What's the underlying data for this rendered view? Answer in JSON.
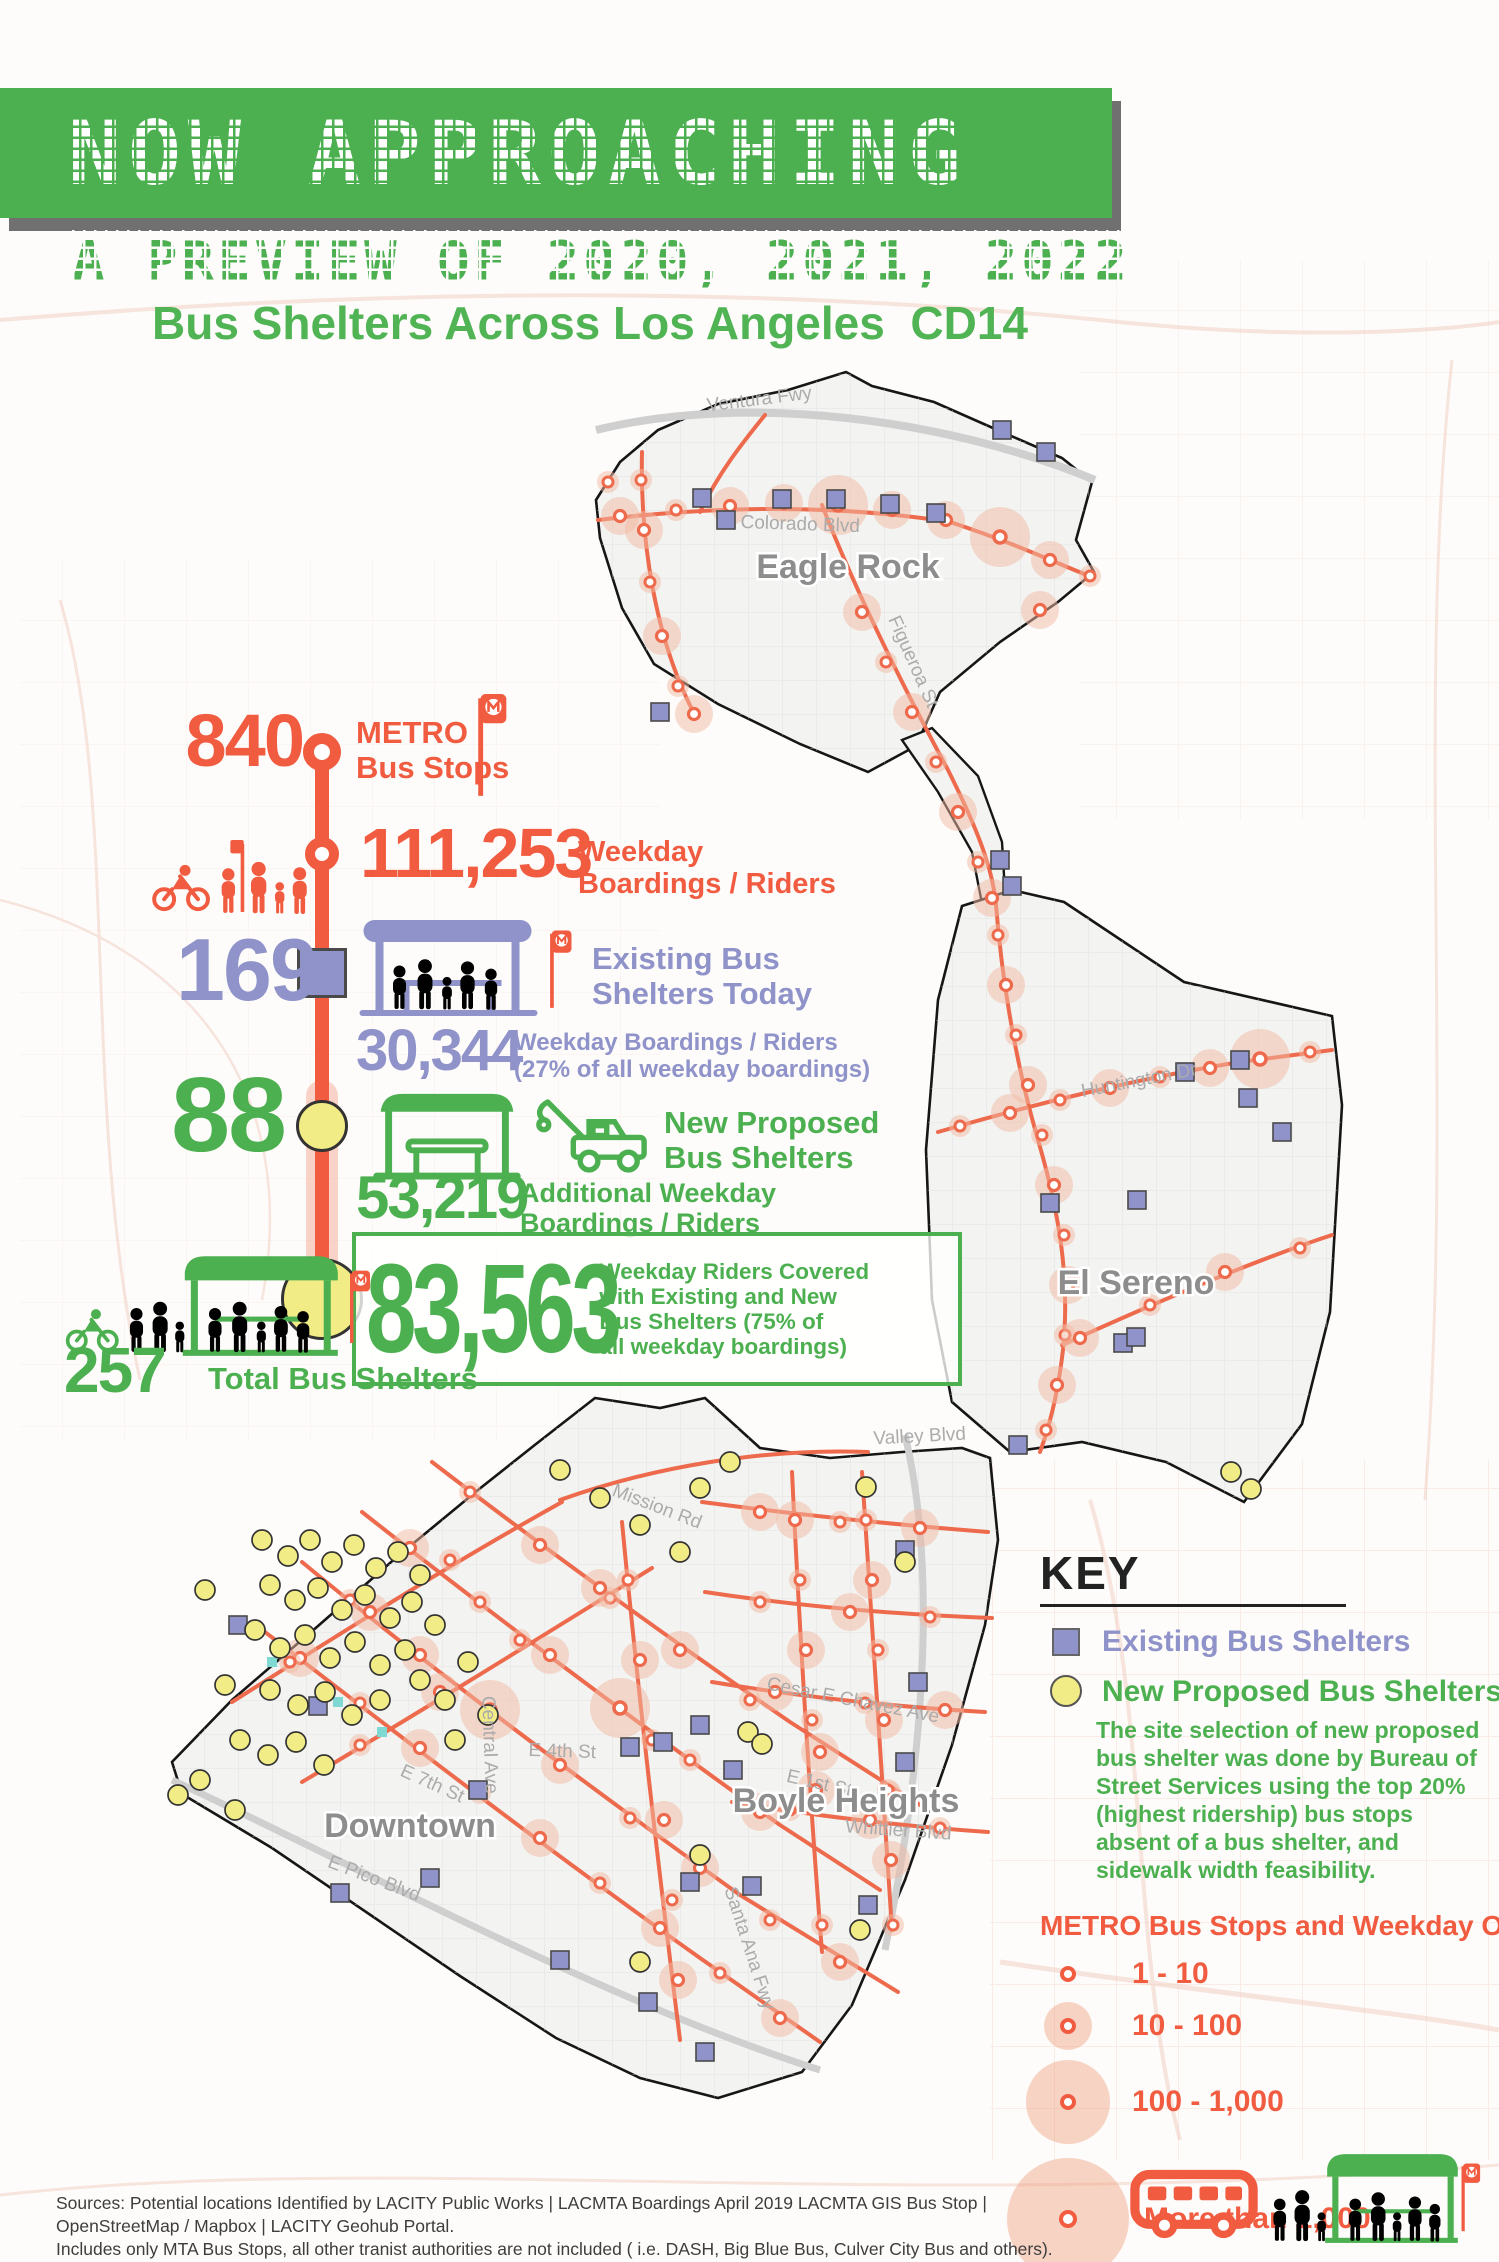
{
  "poster": {
    "banner_title": "NOW APPROACHING",
    "subtitle": "A PREVIEW OF 2020, 2021, 2022",
    "title": "Bus Shelters Across Los Angeles  CD14"
  },
  "stats": {
    "metro_stops": {
      "value": "840",
      "label": "METRO\nBus Stops"
    },
    "boardings": {
      "value": "111,253",
      "label": "Weekday\nBoardings / Riders"
    },
    "existing": {
      "value": "169",
      "label": "Existing Bus\nShelters Today",
      "sub_value": "30,344",
      "sub_label": "Weekday Boardings / Riders\n(27% of all weekday boardings)"
    },
    "proposed": {
      "value": "88",
      "label": "New Proposed\nBus Shelters",
      "sub_value": "53,219",
      "sub_label": "Additional Weekday\nBoardings / Riders"
    },
    "covered": {
      "value": "83,563",
      "label": "Weekday Riders Covered\nwith Existing and New\nBus Shelters (75% of\nall weekday boardings)"
    },
    "total": {
      "value": "257",
      "label": "Total Bus Shelters"
    }
  },
  "map": {
    "neighborhoods": [
      "Eagle Rock",
      "El Sereno",
      "Downtown",
      "Boyle Heights"
    ],
    "streets": [
      "Ventura Fwy",
      "Colorado Blvd",
      "Figueroa St",
      "Huntington Dr",
      "Valley Blvd",
      "Mission Rd",
      "E 4th St",
      "Central Ave",
      "Whittier Blvd",
      "Cesar E Chavez Ave",
      "Santa Ana Fwy",
      "E Pico Blvd",
      "E 7th St",
      "E 1st St"
    ]
  },
  "key": {
    "title": "KEY",
    "existing_label": "Existing Bus Shelters",
    "proposed_label": "New Proposed Bus Shelters",
    "note": "The site selection of new proposed bus shelter was done by Bureau of Street Services using the top 20% (highest ridership) bus stops absent of a bus shelter, and sidewalk width feasibility.",
    "boardings_title": "METRO Bus Stops and Weekday ON Boardings",
    "sizes": [
      {
        "label": "1 - 10"
      },
      {
        "label": "10 - 100"
      },
      {
        "label": "100 - 1,000"
      },
      {
        "label": "More than 1,000"
      }
    ]
  },
  "footer": {
    "line1": "Sources: Potential locations Identified by LACITY Public Works | LACMTA Boardings April 2019 LACMTA GIS Bus Stop | OpenStreetMap / Mapbox | LACITY Geohub Portal.",
    "line2": "Includes only MTA Bus Stops, all other tranist authorities are not included ( i.e. DASH, Big Blue Bus, Culver City Bus and others).",
    "line3": "Data on Bus Stops, Routes, Boardings Counts, Shelter Locations are subject to change. Revised September 2019"
  },
  "colors": {
    "green": "#4CB050",
    "orange": "#F15B40",
    "purple": "#8F93C9",
    "yellow": "#F2EC86",
    "route_orange": "#EE6A4D",
    "stop_halo": "#F2B9A4",
    "boundary": "#161616"
  },
  "icons": {
    "metro_flag": "metro-flag",
    "riders": "cyclist-and-pedestrians",
    "existing_shelter": "bus-shelter-with-riders",
    "proposed_shelter": "bus-shelter-outline",
    "tow_truck": "tow-truck",
    "bus": "bus-outline"
  }
}
